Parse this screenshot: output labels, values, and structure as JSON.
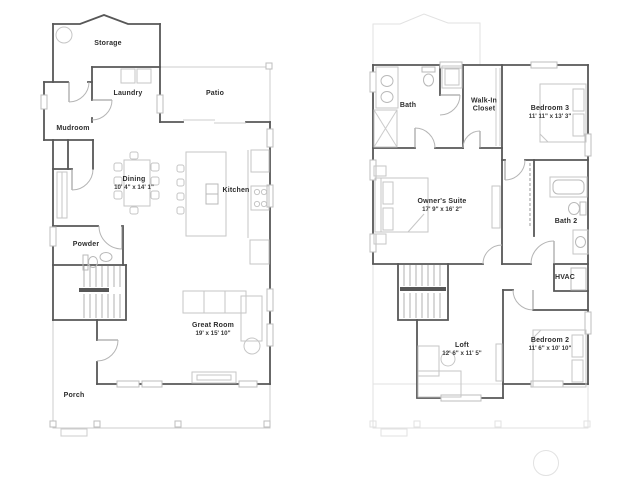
{
  "colors": {
    "wall": "#575757",
    "furniture": "#c6c6c6",
    "faint_overlay": "#e2e2e2",
    "label_text": "#2d2d2d"
  },
  "floor1": {
    "rooms": {
      "storage": {
        "label": "Storage"
      },
      "laundry": {
        "label": "Laundry"
      },
      "patio": {
        "label": "Patio"
      },
      "mudroom": {
        "label": "Mudroom"
      },
      "dining": {
        "label": "Dining",
        "dims": "10' 4\" x 14' 1\""
      },
      "kitchen": {
        "label": "Kitchen"
      },
      "powder": {
        "label": "Powder"
      },
      "great_room": {
        "label": "Great Room",
        "dims": "19' x 15' 10\""
      },
      "porch": {
        "label": "Porch"
      }
    }
  },
  "floor2": {
    "rooms": {
      "bath": {
        "label": "Bath"
      },
      "walk_in_closet": {
        "label": "Walk-In Closet"
      },
      "bedroom3": {
        "label": "Bedroom 3",
        "dims": "11' 11\" x 13' 3\""
      },
      "owners_suite": {
        "label": "Owner's Suite",
        "dims": "17' 9\" x 16' 2\""
      },
      "bath2": {
        "label": "Bath 2"
      },
      "hvac": {
        "label": "HVAC"
      },
      "loft": {
        "label": "Loft",
        "dims": "12' 6\" x 11' 5\""
      },
      "bedroom2": {
        "label": "Bedroom 2",
        "dims": "11' 6\" x 10' 10\""
      }
    }
  }
}
